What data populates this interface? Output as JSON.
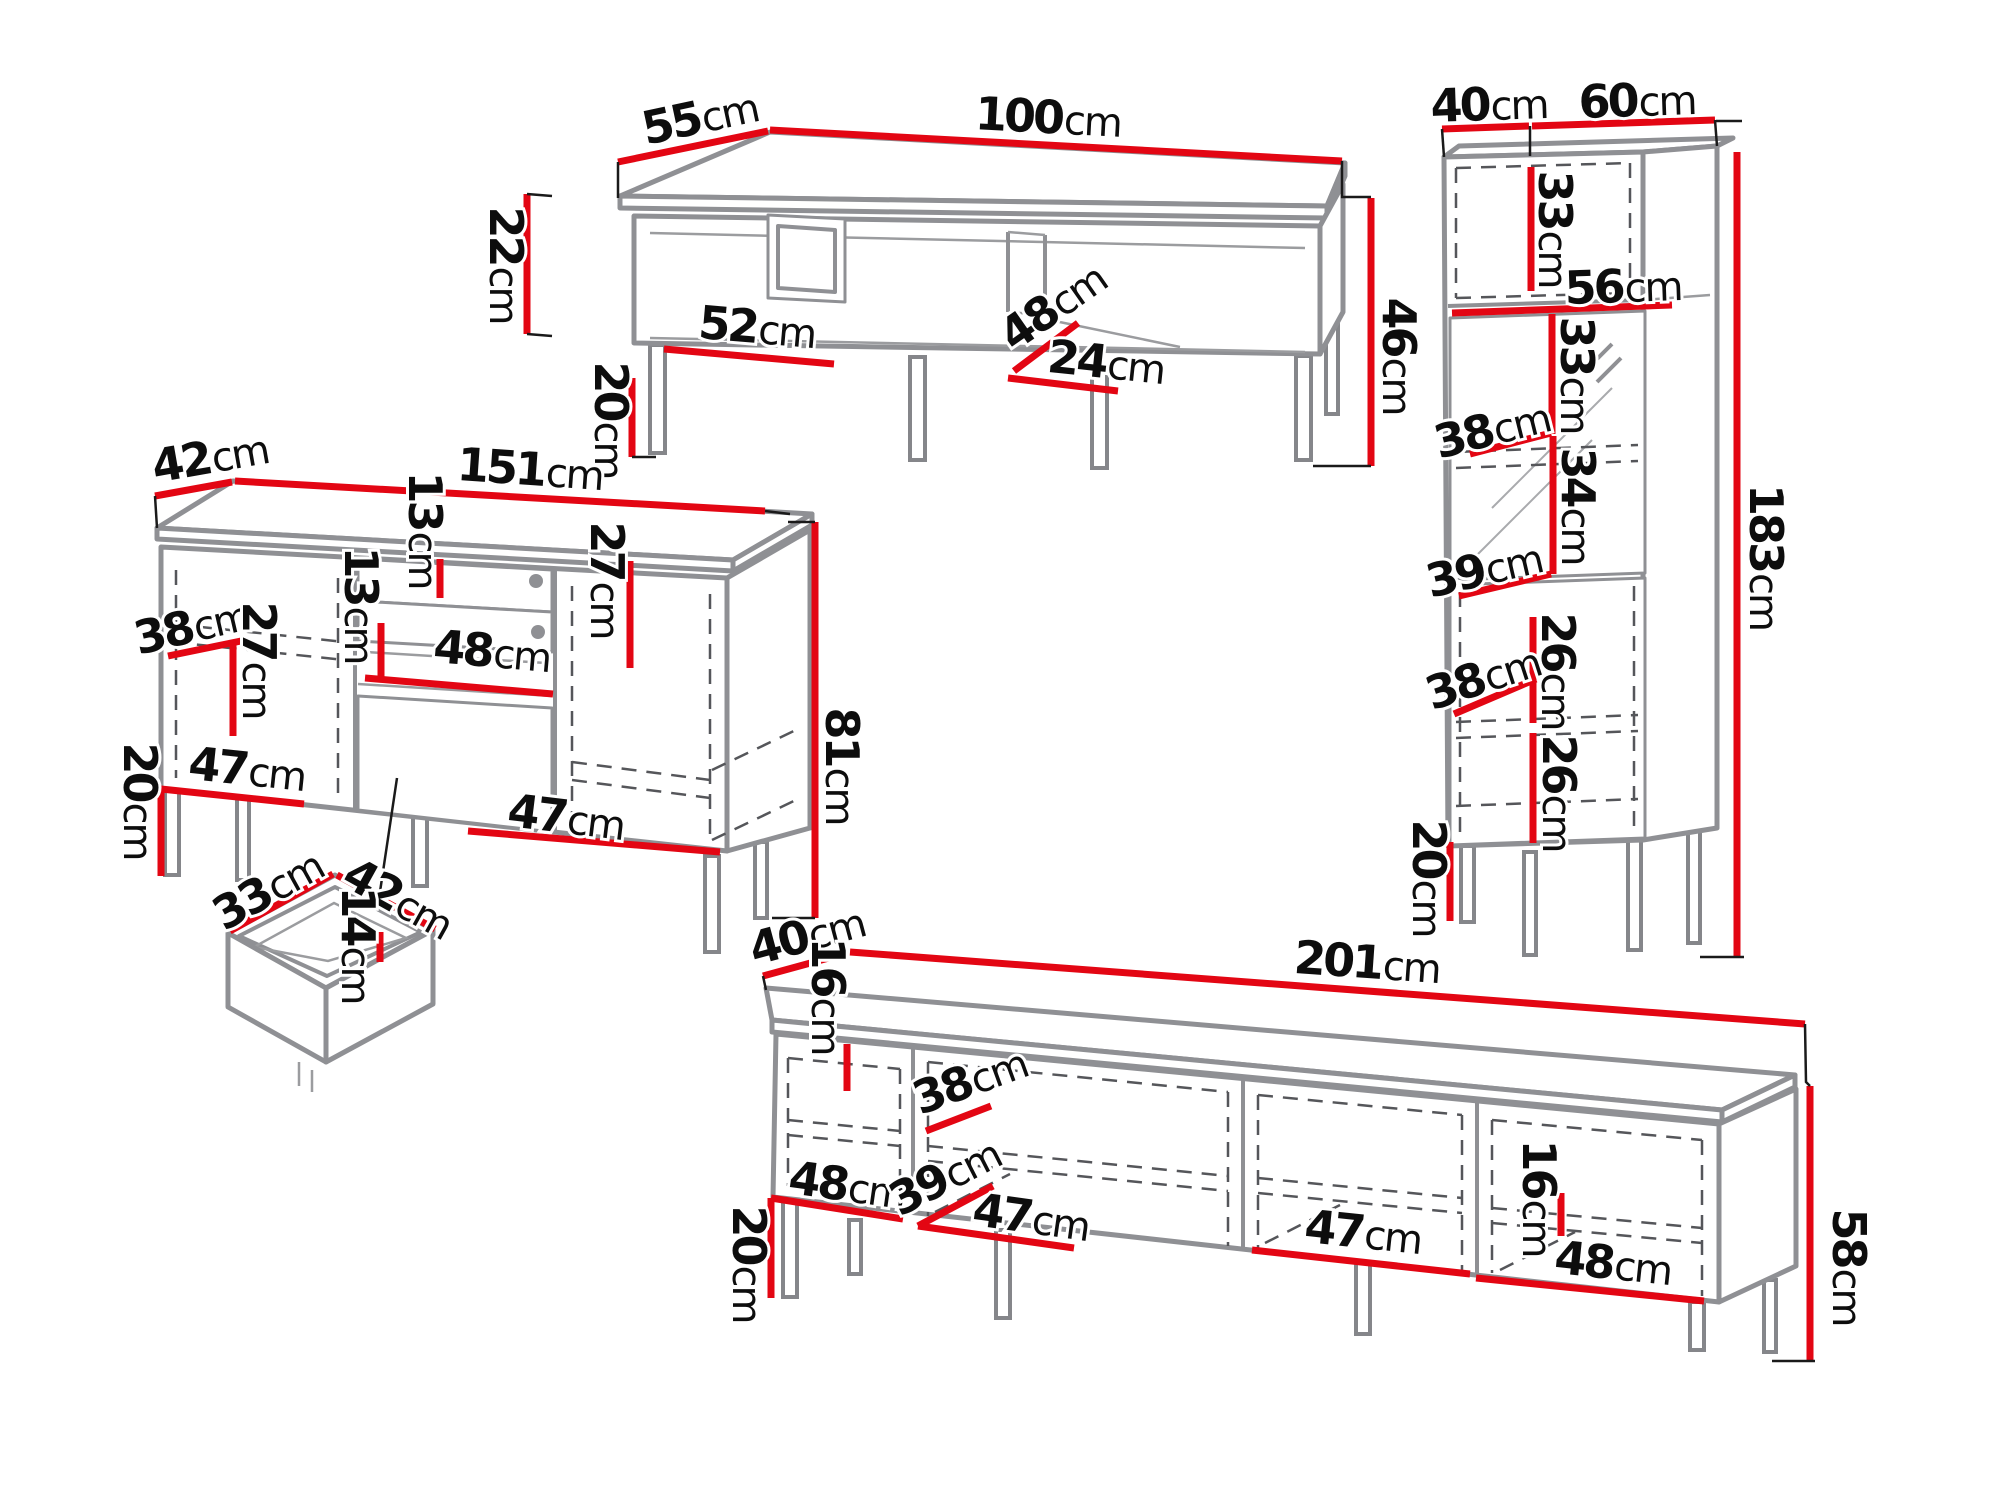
{
  "page": {
    "background": "#ffffff",
    "unit": "cm"
  },
  "colors": {
    "dimension_red": "#e30613",
    "outline_gray": "#8f9094",
    "dashed_gray": "#55565a",
    "label_black": "#0d0d0d"
  },
  "coffee_table": {
    "labels": {
      "depth": {
        "value": "55",
        "unit": "cm"
      },
      "width": {
        "value": "100",
        "unit": "cm"
      },
      "body_height": {
        "value": "22",
        "unit": "cm"
      },
      "leg_height": {
        "value": "20",
        "unit": "cm"
      },
      "shelf_width": {
        "value": "52",
        "unit": "cm"
      },
      "inner_depth": {
        "value": "48",
        "unit": "cm"
      },
      "niche_width": {
        "value": "24",
        "unit": "cm"
      },
      "total_height": {
        "value": "46",
        "unit": "cm"
      }
    }
  },
  "sideboard": {
    "labels": {
      "depth": {
        "value": "42",
        "unit": "cm"
      },
      "width": {
        "value": "151",
        "unit": "cm"
      },
      "upper_drawer_height": {
        "value": "13",
        "unit": "cm"
      },
      "lower_drawer_height": {
        "value": "13",
        "unit": "cm"
      },
      "shelf_depth": {
        "value": "38",
        "unit": "cm"
      },
      "left_shelf_height": {
        "value": "27",
        "unit": "cm"
      },
      "right_shelf_height": {
        "value": "27",
        "unit": "cm"
      },
      "niche_width": {
        "value": "48",
        "unit": "cm"
      },
      "left_door_width": {
        "value": "47",
        "unit": "cm"
      },
      "right_door_width": {
        "value": "47",
        "unit": "cm"
      },
      "leg_height": {
        "value": "20",
        "unit": "cm"
      },
      "total_height": {
        "value": "81",
        "unit": "cm"
      }
    }
  },
  "drawer_detail": {
    "labels": {
      "width": {
        "value": "33",
        "unit": "cm"
      },
      "depth": {
        "value": "42",
        "unit": "cm"
      },
      "height": {
        "value": "14",
        "unit": "cm"
      }
    }
  },
  "tall_cabinet": {
    "labels": {
      "depth": {
        "value": "40",
        "unit": "cm"
      },
      "width": {
        "value": "60",
        "unit": "cm"
      },
      "top_niche_height": {
        "value": "33",
        "unit": "cm"
      },
      "shelf_width": {
        "value": "56",
        "unit": "cm"
      },
      "glass_upper_height": {
        "value": "33",
        "unit": "cm"
      },
      "glass_shelf_depth": {
        "value": "38",
        "unit": "cm"
      },
      "glass_lower_height": {
        "value": "34",
        "unit": "cm"
      },
      "middle_shelf_depth": {
        "value": "39",
        "unit": "cm"
      },
      "lower_upper_height": {
        "value": "26",
        "unit": "cm"
      },
      "lower_shelf_depth": {
        "value": "38",
        "unit": "cm"
      },
      "lower_bottom_height": {
        "value": "26",
        "unit": "cm"
      },
      "total_height": {
        "value": "183",
        "unit": "cm"
      },
      "leg_height": {
        "value": "20",
        "unit": "cm"
      }
    }
  },
  "tv_stand": {
    "labels": {
      "depth": {
        "value": "40",
        "unit": "cm"
      },
      "width": {
        "value": "201",
        "unit": "cm"
      },
      "left_shelf_height": {
        "value": "16",
        "unit": "cm"
      },
      "shelf_depth": {
        "value": "38",
        "unit": "cm"
      },
      "compartment1_width": {
        "value": "48",
        "unit": "cm"
      },
      "middle_shelf_depth": {
        "value": "39",
        "unit": "cm"
      },
      "compartment2_width": {
        "value": "47",
        "unit": "cm"
      },
      "compartment3_width": {
        "value": "47",
        "unit": "cm"
      },
      "right_shelf_height": {
        "value": "16",
        "unit": "cm"
      },
      "compartment4_width": {
        "value": "48",
        "unit": "cm"
      },
      "leg_height": {
        "value": "20",
        "unit": "cm"
      },
      "total_height": {
        "value": "58",
        "unit": "cm"
      }
    }
  }
}
